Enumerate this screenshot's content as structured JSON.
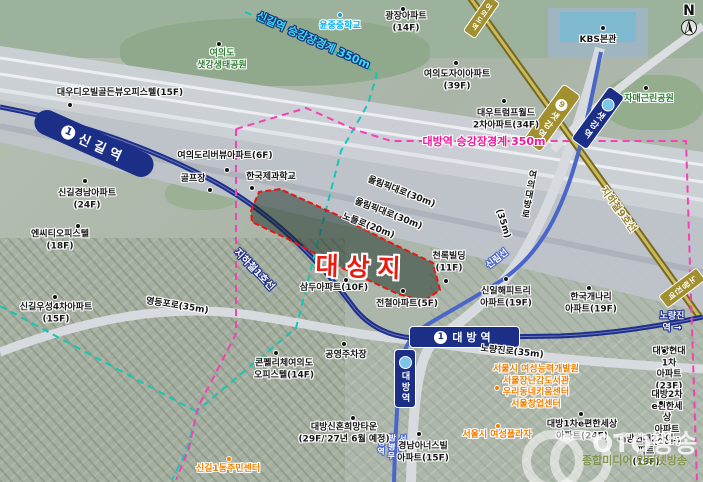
{
  "compass": {
    "label": "N"
  },
  "site": {
    "label": "대상지"
  },
  "boundaries": {
    "singil_label": "신길역 승강장경계 350m",
    "daebang_label": "대방역 승강장경계 350m"
  },
  "stations": {
    "singil": {
      "badge": "1",
      "name": "신길역"
    },
    "daebang_line1": {
      "badge": "1",
      "name": "대방역"
    },
    "daebang_sillim": {
      "name": "대방역"
    },
    "saetgang_line9": {
      "badge": "9",
      "name": "샛강역"
    },
    "saetgang_sillim": {
      "name": "샛강역"
    }
  },
  "rail": {
    "line1_label": "지하철1호선",
    "line9_label": "지하철9호선",
    "sillim_label": "신림선",
    "noryangjin_dir_line1": "노량진역 →",
    "noryangjin_dir_line9": "노량진역",
    "yeouido_dir_line9": "여의도역",
    "byeongmucheong_label": "서울지방병무청역"
  },
  "roads": {
    "olympic_1": "올림픽대로(30m)",
    "olympic_2": "올림픽대로(30m)",
    "nodeul": "노들로(20m)",
    "yeongdeungpo": "영등포로(35m)",
    "noryangjin": "노량진로(35m)",
    "yeouidaebang": "여의대방로",
    "yeouidaebang_width": "(35m)"
  },
  "places": [
    {
      "label": "광장아파트\n(14F)"
    },
    {
      "label": "KBS본관"
    },
    {
      "label": "여의도자이아파트\n(39F)"
    },
    {
      "label": "대우트럼프월드\n2차아파트(34F)"
    },
    {
      "label": "대우디오빌골든뷰오피스텔(15F)"
    },
    {
      "label": "신길경남아파트\n(24F)"
    },
    {
      "label": "엔씨티오피스텔\n(18F)"
    },
    {
      "label": "여의도리버뷰아파트(6F)"
    },
    {
      "label": "골프장"
    },
    {
      "label": "한국제과학교"
    },
    {
      "label": "신길우성4차아파트\n(15F)"
    },
    {
      "label": "삼두아파트(10F)"
    },
    {
      "label": "전철아파트(5F)"
    },
    {
      "label": "천록빌딩\n(11F)"
    },
    {
      "label": "신일해피트리\n아파트(19F)"
    },
    {
      "label": "한국개나리\n아파트(19F)"
    },
    {
      "label": "대방현대1차\n아파트(23F)"
    },
    {
      "label": "대방2차e편한세상\n아파트(18F)"
    },
    {
      "label": "대방1차e편한세상\n아파트(24F)"
    },
    {
      "label": "대방현대2차아파트\n(19F)"
    },
    {
      "label": "경남아너스빌\n아파트(15F)"
    },
    {
      "label": "대방신혼희망타운\n(29F/'27년 6월 예정)"
    },
    {
      "label": "콘펠리체여의도\n오피스텔(14F)"
    },
    {
      "label": "공영주차장"
    },
    {
      "label": "여의도\n샛강생태공원"
    },
    {
      "label": "자매근린공원"
    },
    {
      "label": "윤중중학교"
    },
    {
      "label": "신길1동주민센터"
    },
    {
      "label": "서울시 여성능력개발원\n서울장난감도서관\n우리동네키움센터\n서울창업센터"
    },
    {
      "label": "서울시 여성플라자"
    }
  ],
  "watermark": {
    "title": "OTO방송",
    "subtitle": "종합미디어 인터넷방송"
  }
}
